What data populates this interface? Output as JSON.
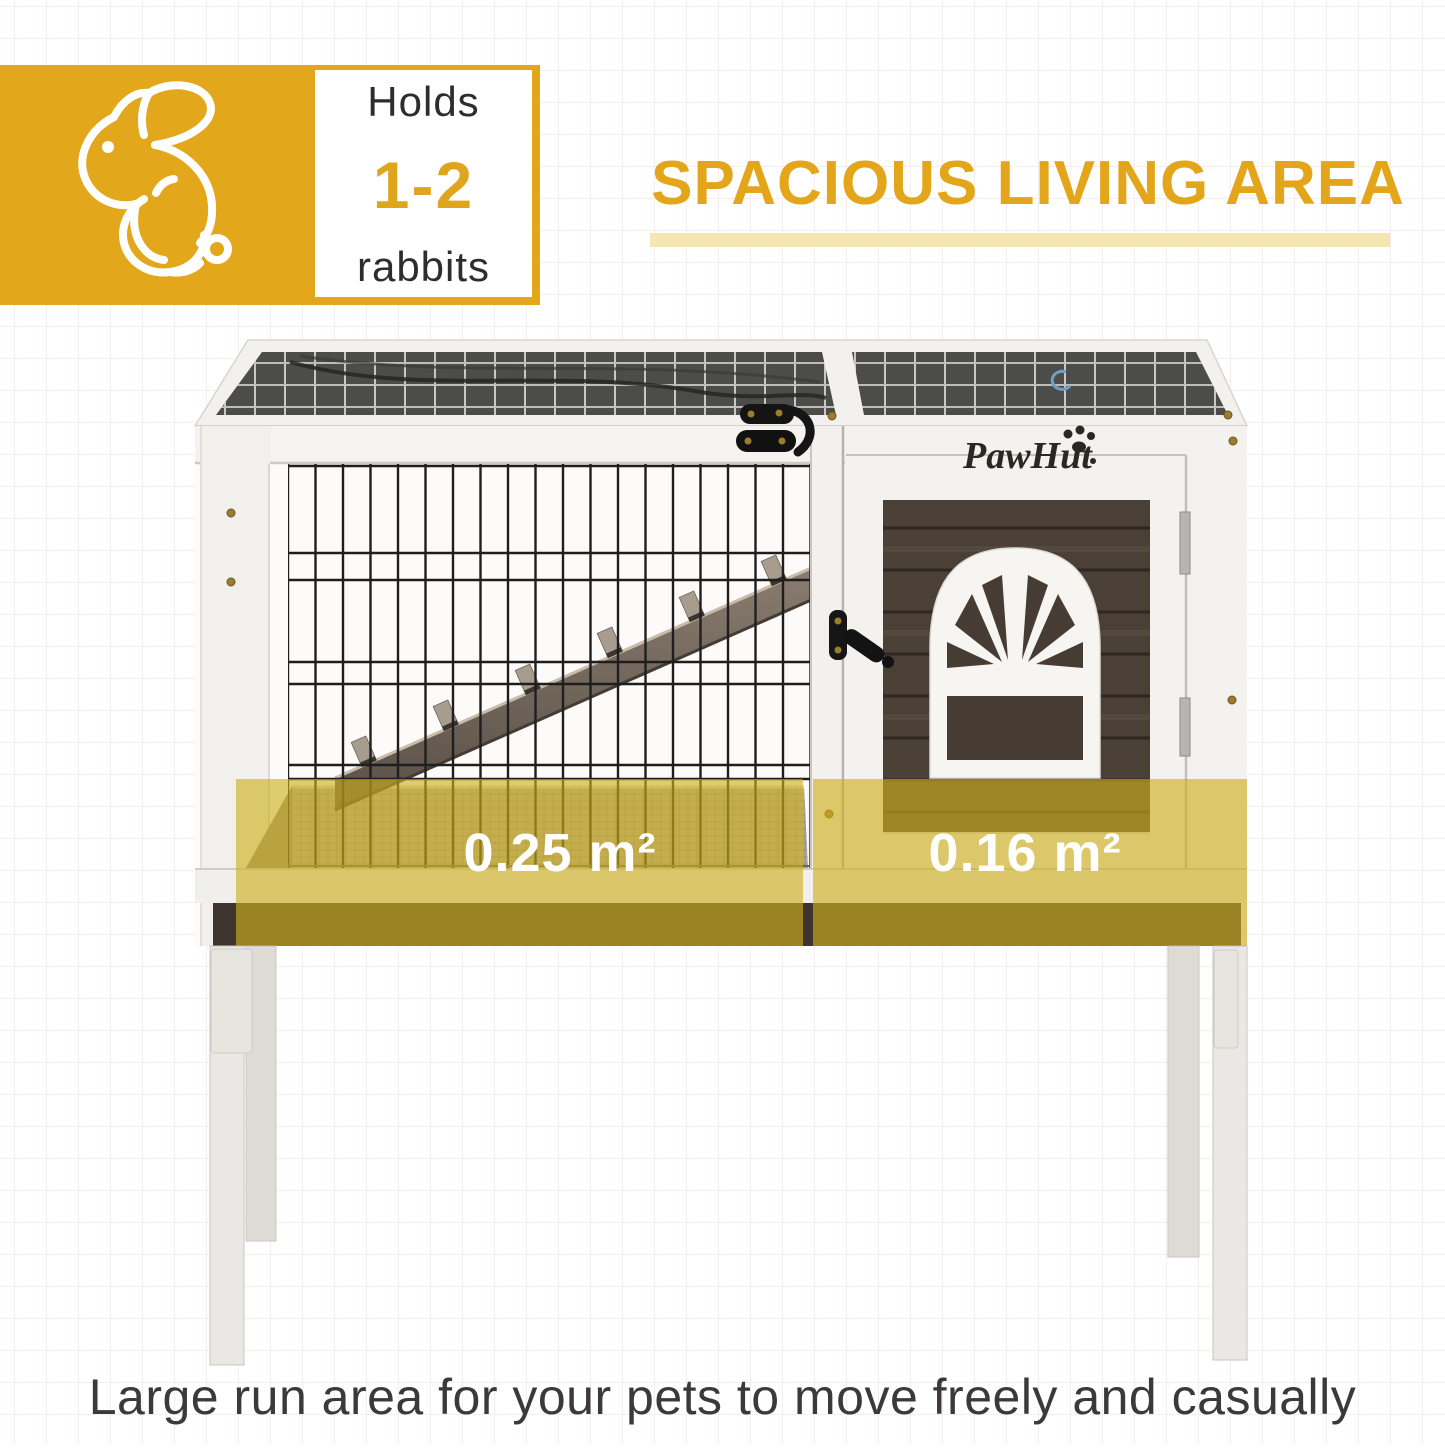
{
  "badge": {
    "icon": "rabbit-icon",
    "holds": "Holds",
    "count": "1-2",
    "animal": "rabbits"
  },
  "heading": {
    "title": "SPACIOUS LIVING AREA"
  },
  "photo": {
    "brand_logo": "PawHut",
    "run_area_label": "0.25 m²",
    "hutch_area_label": "0.16 m²"
  },
  "caption": "Large run area for your pets to move freely and casually",
  "colors": {
    "brand_yellow": "#E2A71B",
    "heading_yellow": "#E3A51A",
    "underline_pale_yellow": "#F5E6B4",
    "area_overlay_yellow": "rgba(206,176,28,0.63)",
    "label_white": "#FFFFFF",
    "text_dark": "#2D2D2D",
    "door_wood_brown": "#4A4036"
  }
}
